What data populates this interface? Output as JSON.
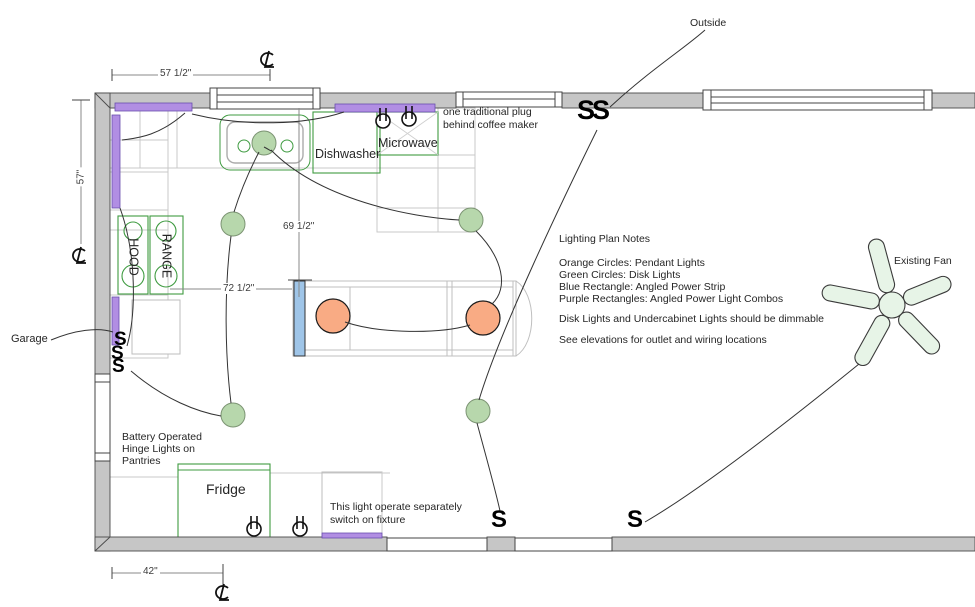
{
  "plan": {
    "room_labels": {
      "garage": "Garage",
      "outside": "Outside",
      "existing_fan": "Existing Fan"
    },
    "appliances": {
      "dishwasher": "Dishwasher",
      "microwave": "Microwave",
      "hood": "HOOD",
      "range": "RANGE",
      "fridge": "Fridge"
    },
    "annotations": {
      "coffee": {
        "line1": "one traditional plug",
        "line2": "behind coffee maker"
      },
      "pantry": {
        "line1": "Battery Operated",
        "line2": "Hinge Lights on",
        "line3": "Pantries"
      },
      "fixture": {
        "line1": "This light operate separately",
        "line2": "switch on fixture"
      }
    },
    "notes": {
      "title": "Lighting Plan Notes",
      "legend": [
        "Orange Circles: Pendant Lights",
        "Green Circles: Disk Lights",
        "Blue Rectangle: Angled Power Strip",
        "Purple Rectangles: Angled Power Light Combos"
      ],
      "dimmable": "Disk Lights and Undercabinet Lights should be dimmable",
      "elevations": "See elevations for outlet and wiring locations"
    },
    "dimensions": {
      "top": "57 1/2\"",
      "left": "57\"",
      "sink_to_island": "69 1/2\"",
      "range_to_island": "72 1/2\"",
      "bottom": "42\""
    },
    "switches": {
      "top": "SS",
      "garage": [
        "S",
        "S",
        "S"
      ],
      "bottom_left": "S",
      "bottom_right": "S"
    },
    "fixture_counts": {
      "pendant_lights": 2,
      "disk_lights": 5,
      "duplex_outlets": 4,
      "ceiling_fans": 1
    },
    "icons": {
      "centerline_icon": "℄",
      "switch_icon": "S",
      "outlet_icon": "duplex-outlet-circle",
      "fan_icon": "5-blade-ceiling-fan"
    },
    "colors": {
      "pendant_light": "#f9ab84",
      "disk_light": "#b7d7ac",
      "angled_power_strip": "#9fc5e8",
      "angled_power_light_combo": "#b18ee3",
      "wall": "#c6c6c6",
      "fan": "#e7f4e7",
      "cabinet_green": "#3f9b41"
    }
  }
}
